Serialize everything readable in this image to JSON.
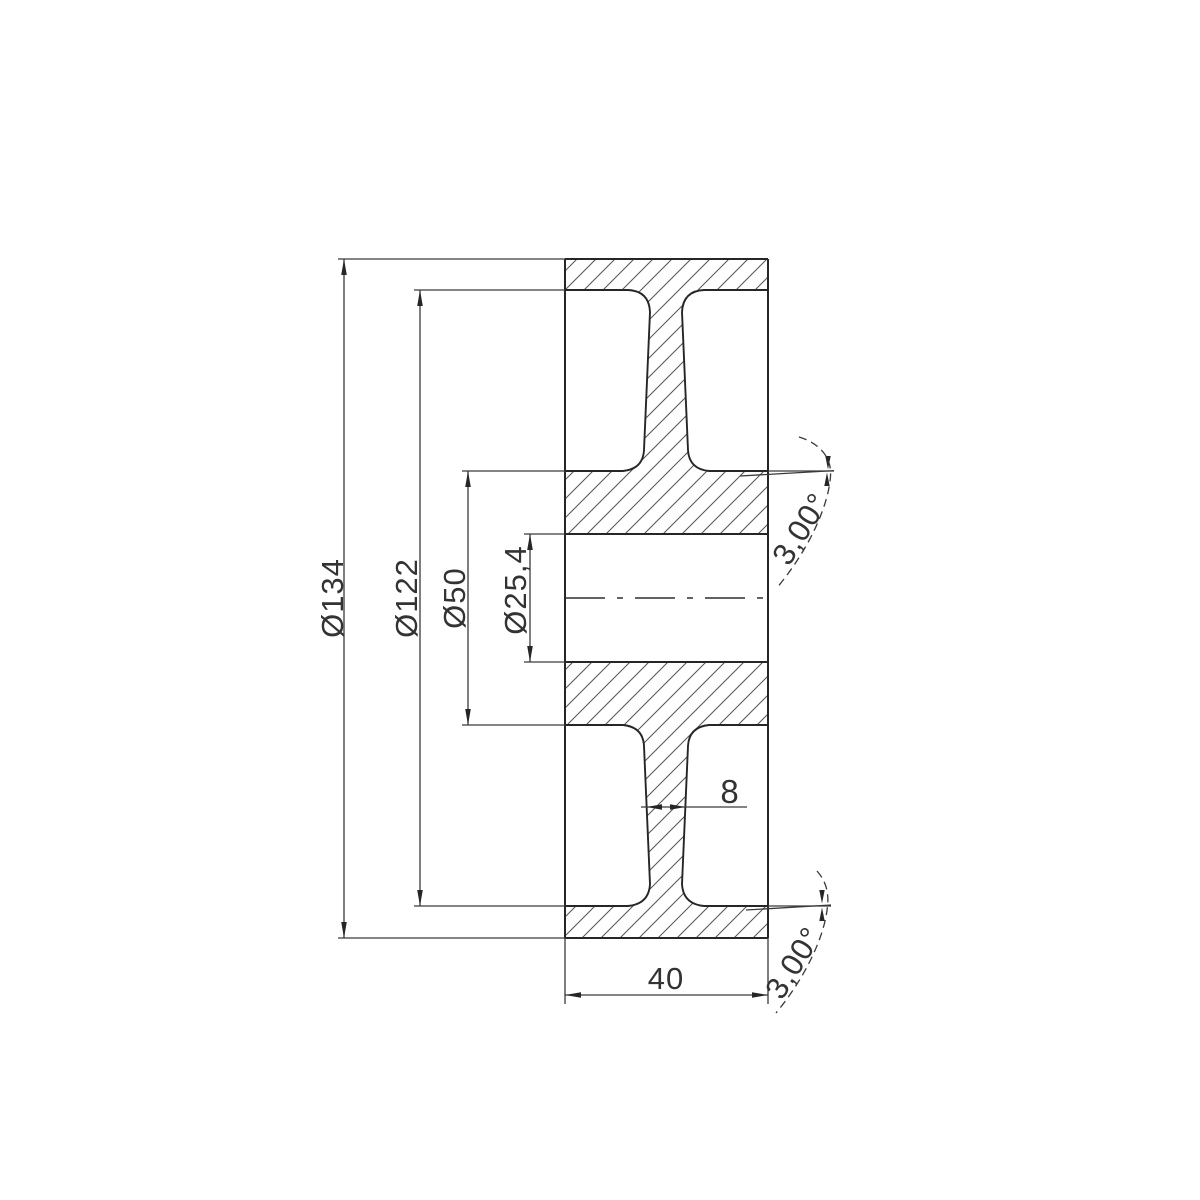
{
  "drawing": {
    "kind": "wheel cross-section technical drawing",
    "dimensions": {
      "outer_diameter": "Ø134",
      "rim_inner_diameter": "Ø122",
      "hub_diameter": "Ø50",
      "bore_diameter": "Ø25,4",
      "web_thickness": "8",
      "overall_width": "40",
      "draft_angle_upper": "3,00°",
      "draft_angle_lower": "3,00°"
    },
    "colors": {
      "background": "#ffffff",
      "line": "#262626",
      "dimension_line": "#3a3a3a",
      "hatch": "#555555",
      "text": "#333333"
    }
  }
}
